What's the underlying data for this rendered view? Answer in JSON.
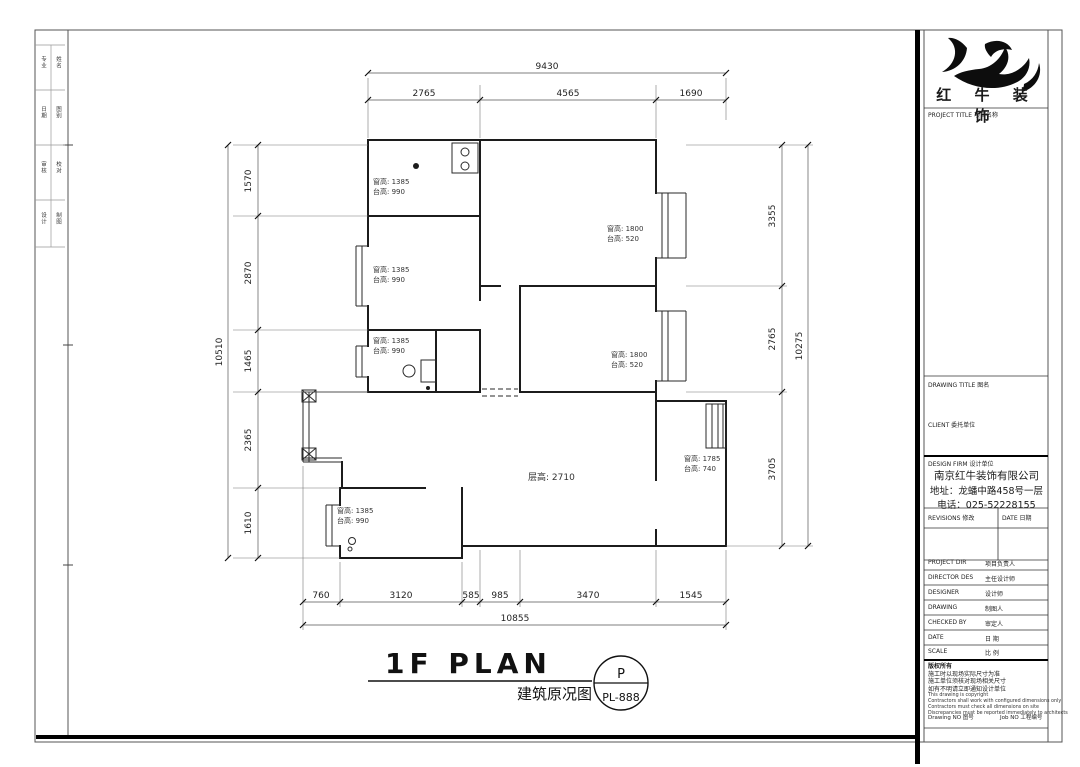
{
  "logo": {
    "company_name": "红 牛 装 饰",
    "project_title_row": "PROJECT TITLE 项目名称"
  },
  "titleblock": {
    "drawing_title_row": "DRAWING TITLE 图名",
    "client_row": "CLIENT 委托单位",
    "design_firm_row": "DESIGN FIRM 设计单位",
    "company": "南京红牛装饰有限公司",
    "address": "地址：龙蟠中路458号一层",
    "phone": "电话：025-52228155",
    "revisions_label": "REVISIONS 修改",
    "date_label": "DATE 日期",
    "rows": [
      {
        "en": "PROJECT DIR",
        "zh": "项目负责人"
      },
      {
        "en": "DIRECTOR DES",
        "zh": "主任设计师"
      },
      {
        "en": "DESIGNER",
        "zh": "设计师"
      },
      {
        "en": "DRAWING",
        "zh": "制图人"
      },
      {
        "en": "CHECKED BY",
        "zh": "审定人"
      },
      {
        "en": "DATE",
        "zh": "日 期"
      },
      {
        "en": "SCALE",
        "zh": "比 例"
      }
    ],
    "notes": [
      "版权所有",
      "施工时以现场实际尺寸为准",
      "施工单位须核对现场相关尺寸",
      "如有不明请立即通知设计单位",
      "This drawing is copyright",
      "Contractors shall work with configured dimensions only",
      "Contractors must check all dimensions on site",
      "Discrepancies must be reported immediately to architects"
    ],
    "drawing_no_label": "Drawing NO 图号",
    "job_no_label": "Job NO 工程编号"
  },
  "left_strip": {
    "cells": [
      [
        "专业",
        "姓名"
      ],
      [
        "日期",
        "图别"
      ],
      [
        "审核",
        "校对"
      ],
      [
        "设计",
        "制图"
      ]
    ]
  },
  "plan_title": {
    "main": "1F PLAN",
    "sub": "建筑原况图",
    "badge_top": "P",
    "badge_no": "PL-888"
  },
  "dims": {
    "top": {
      "total": "9430",
      "segments": [
        "2765",
        "4565",
        "1690"
      ]
    },
    "left": {
      "total": "10510",
      "segments": [
        "1570",
        "2870",
        "1465",
        "2365",
        "1610"
      ]
    },
    "right": {
      "total": "10275",
      "segments": [
        "3355",
        "2765",
        "3705"
      ]
    },
    "bottom": {
      "total": "10855",
      "segments": [
        "760",
        "3120",
        "585",
        "985",
        "3470",
        "1545"
      ]
    }
  },
  "rooms": {
    "window_labels": [
      {
        "line1": "窗高: 1385",
        "line2": "台高: 990"
      },
      {
        "line1": "窗高: 1385",
        "line2": "台高: 990"
      },
      {
        "line1": "窗高: 1385",
        "line2": "台高: 990"
      },
      {
        "line1": "窗高: 1800",
        "line2": "台高: 520"
      },
      {
        "line1": "窗高: 1800",
        "line2": "台高: 520"
      },
      {
        "line1": "窗高: 1785",
        "line2": "台高: 740"
      },
      {
        "line1": "窗高: 1385",
        "line2": "台高: 990"
      }
    ],
    "ceiling_height": "层高: 2710"
  }
}
